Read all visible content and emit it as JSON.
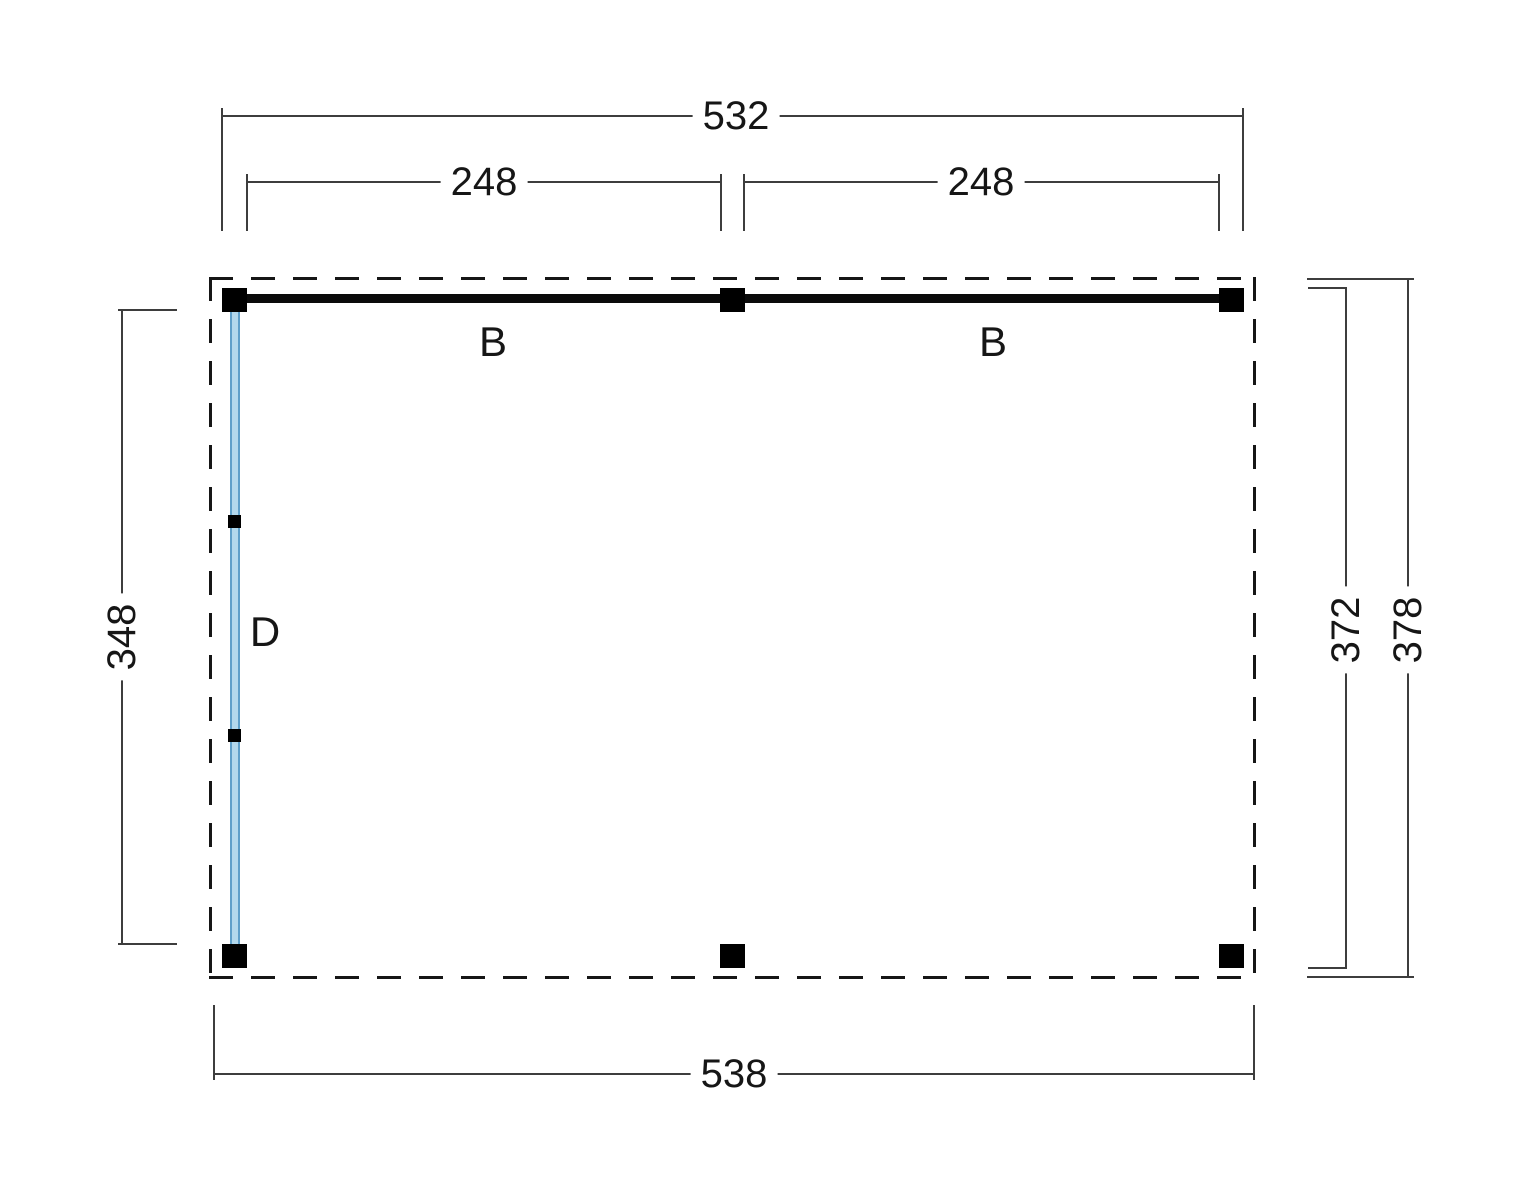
{
  "drawing": {
    "type": "floor-plan",
    "dimensions": {
      "top_total": "532",
      "top_span_left": "248",
      "top_span_right": "248",
      "side_left": "348",
      "side_right_inner": "372",
      "side_right_outer": "378",
      "bottom_total": "538"
    },
    "labels": {
      "beam_left": "B",
      "beam_right": "B",
      "wall_left": "D"
    },
    "colors": {
      "line": "#161616",
      "dim": "#3d3d3d",
      "post": "#000000",
      "beam": "#0a0a0a",
      "wall_fill": "#b3d8ec",
      "wall_edge": "#5f9fc9",
      "bg": "#ffffff"
    }
  }
}
